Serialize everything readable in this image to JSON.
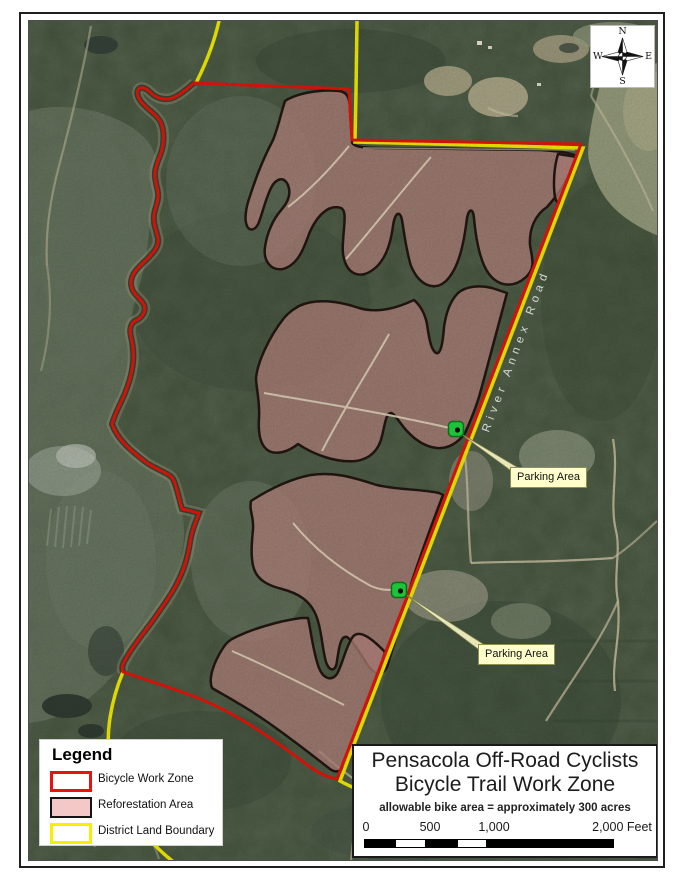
{
  "title_box": {
    "line1": "Pensacola Off-Road Cyclists",
    "line2": "Bicycle Trail Work Zone",
    "subtitle": "allowable bike area = approximately 300 acres"
  },
  "scale_bar": {
    "ticks": [
      "0",
      "500",
      "1,000",
      "2,000 Feet"
    ]
  },
  "legend": {
    "title": "Legend",
    "items": [
      {
        "label": "Bicycle Work Zone",
        "swatch_fill": "#ffffff",
        "swatch_border": "#e8130c"
      },
      {
        "label": "Reforestation Area",
        "swatch_fill": "#f5c8c8",
        "swatch_border": "#141414"
      },
      {
        "label": "District Land Boundary",
        "swatch_fill": "#ffffff",
        "swatch_border": "#f5ef00"
      }
    ]
  },
  "compass": {
    "n": "N",
    "e": "E",
    "s": "S",
    "w": "W"
  },
  "map": {
    "road_label": "River Annex Road",
    "parking": [
      {
        "label": "Parking Area"
      },
      {
        "label": "Parking Area"
      }
    ],
    "colors": {
      "work_zone_line": "#e8150a",
      "district_boundary_line": "#f5ef00",
      "reforestation_fill": "#b5847e",
      "reforestation_outline": "#241712",
      "parking_dot": "#22d841",
      "callout_background": "#ffffcc"
    }
  }
}
